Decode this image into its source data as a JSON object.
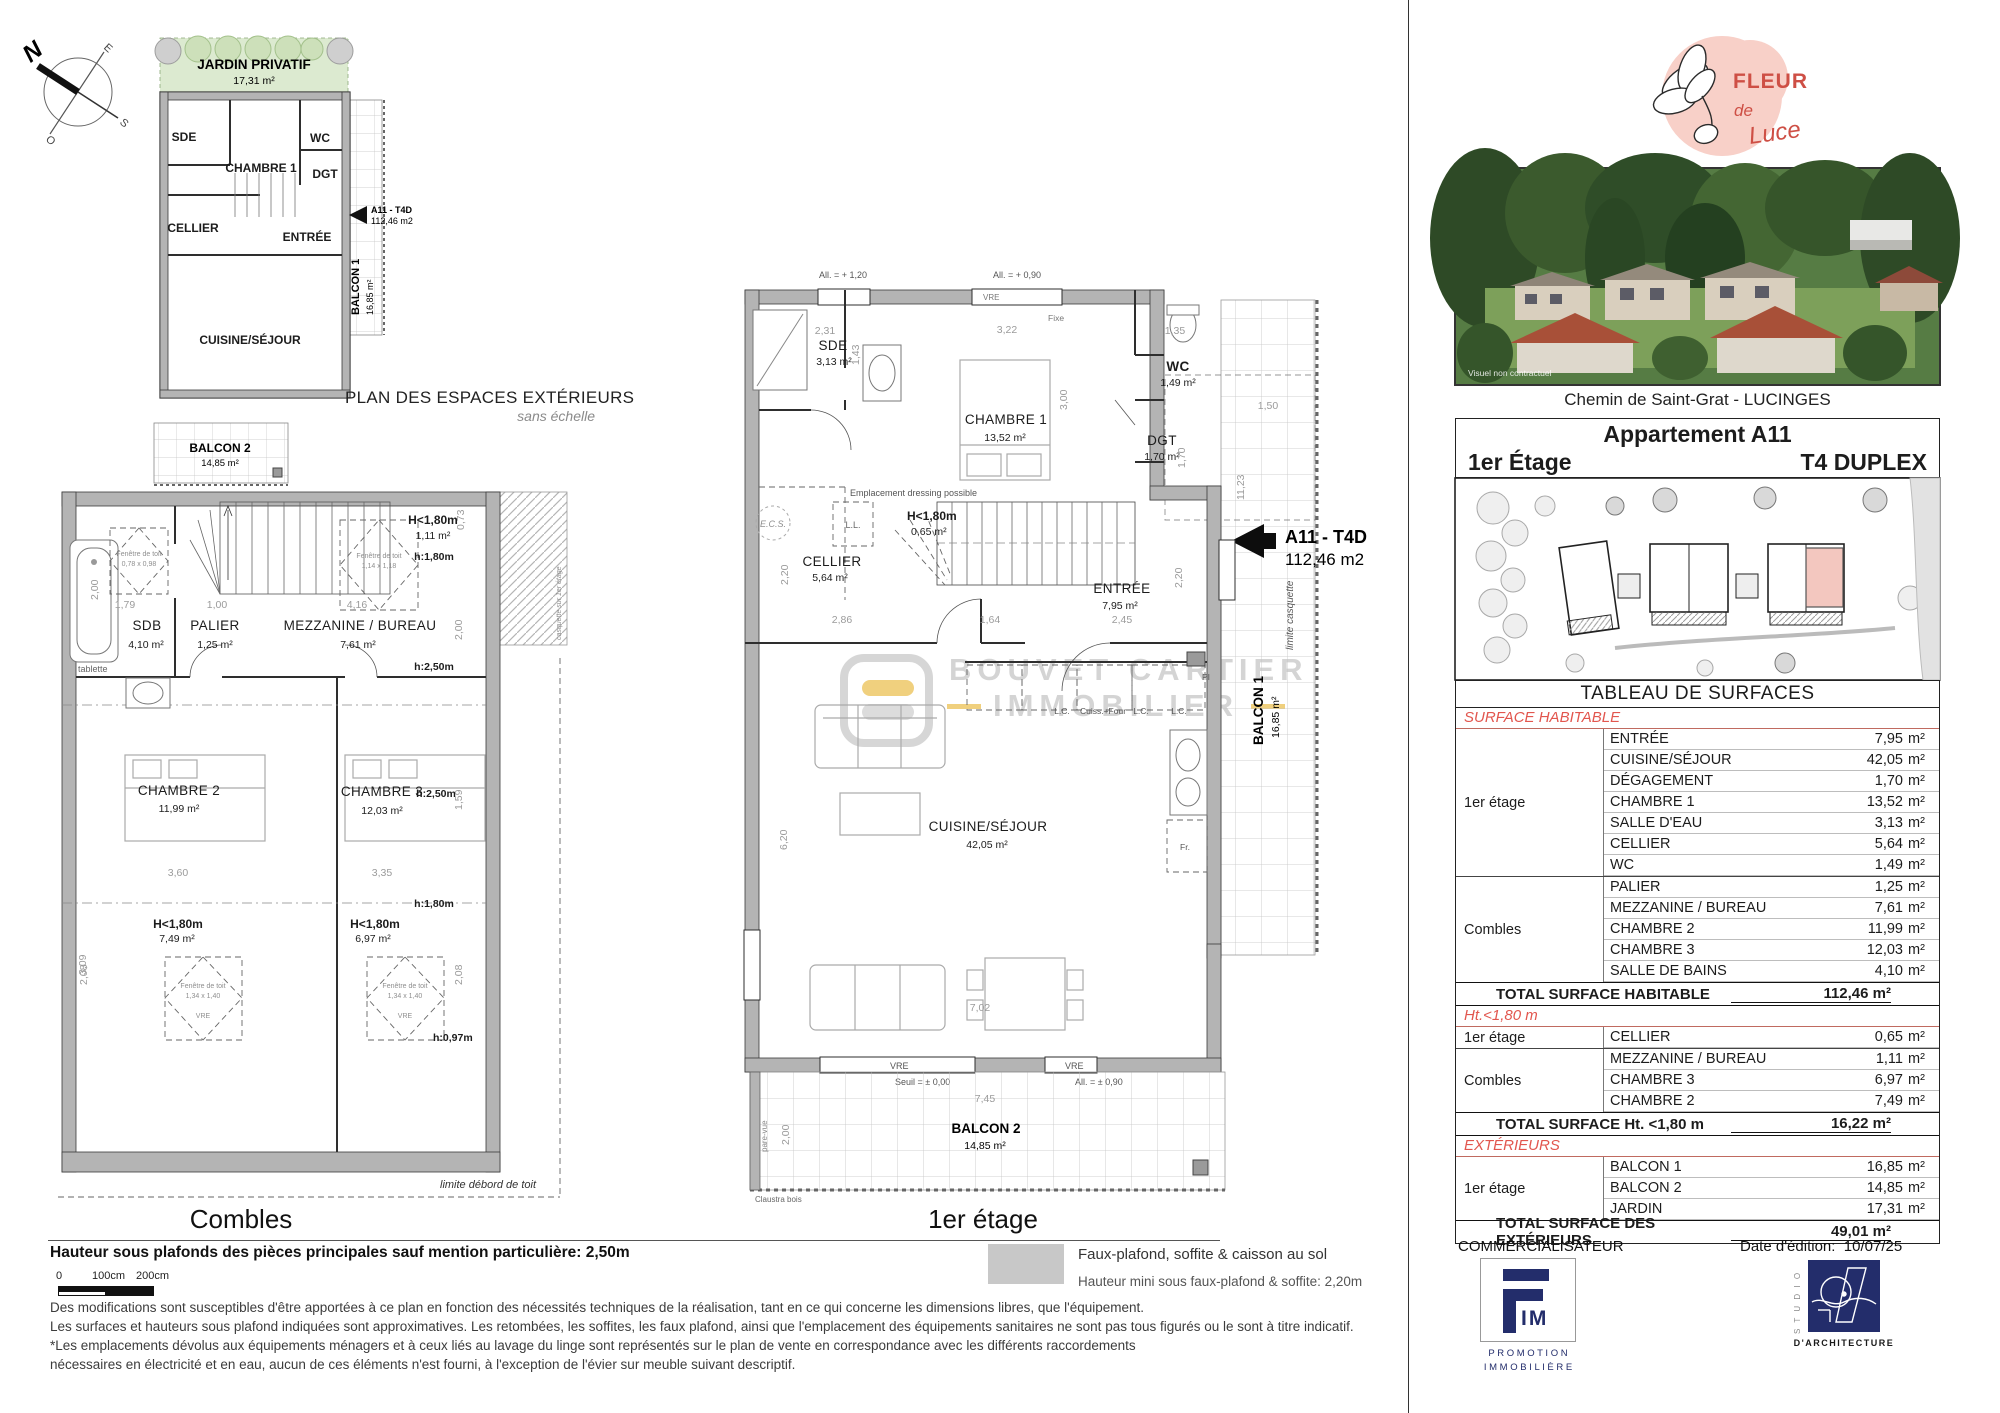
{
  "compass": {
    "n": "N",
    "e": "E",
    "s": "S",
    "o": "O"
  },
  "exterior_plan": {
    "title": "PLAN DES ESPACES EXTÉRIEURS",
    "subtitle": "sans échelle",
    "jardin_name": "JARDIN PRIVATIF",
    "jardin_area": "17,31 m²",
    "rooms": {
      "sde": "SDE",
      "chambre1": "CHAMBRE 1",
      "wc": "WC",
      "dgt": "DGT",
      "cellier": "CELLIER",
      "entree": "ENTRÉE",
      "cuisine": "CUISINE/SÉJOUR"
    },
    "balcon1_name": "BALCON 1",
    "balcon1_area": "16,85 m²",
    "balcon2_name": "BALCON 2",
    "balcon2_area": "14,85 m²",
    "tag_code": "A11 - T4D",
    "tag_area": "112,46 m2"
  },
  "combles": {
    "title": "Combles",
    "rooms": {
      "sdb": "SDB",
      "sdb_area": "4,10 m²",
      "palier": "PALIER",
      "palier_area": "1,25 m²",
      "mezz": "MEZZANINE / BUREAU",
      "mezz_area": "7,61 m²",
      "ch2": "CHAMBRE 2",
      "ch2_area": "11,99 m²",
      "ch3": "CHAMBRE 3",
      "ch3_area": "12,03 m²"
    },
    "low1": "H<1,80m",
    "low1_area": "1,11 m²",
    "low2_area": "7,49 m²",
    "low3_area": "6,97 m²",
    "notes": {
      "h180": "h:1,80m",
      "h250": "h:2,50m",
      "h097": "h:0,97m",
      "tablette": "tablette",
      "casquette": "casquette sur 1er étage",
      "limite": "limite débord de toit",
      "fen": "Fenêtre de toit",
      "fen_size": "1,34 x 1,40",
      "fen_size2": "1,14 x 1,18",
      "fen_size3": "0,78 x 0,98",
      "vre": "VRE"
    },
    "dims": {
      "d200": "2,00",
      "d179": "1,79",
      "d100": "1,00",
      "d416": "4,16",
      "d073": "0,73",
      "d360": "3,60",
      "d335": "3,35",
      "d309": "3,09",
      "d208": "2,08",
      "d159": "1,59"
    }
  },
  "etage": {
    "title": "1er étage",
    "rooms": {
      "sde": "SDE",
      "sde_area": "3,13 m²",
      "ch1": "CHAMBRE 1",
      "ch1_area": "13,52 m²",
      "wc": "WC",
      "wc_area": "1,49 m²",
      "dgt": "DGT",
      "dgt_area": "1,70 m²",
      "cellier": "CELLIER",
      "cellier_area": "5,64 m²",
      "entree": "ENTRÉE",
      "entree_area": "7,95 m²",
      "cuisine": "CUISINE/SÉJOUR",
      "cuisine_area": "42,05 m²",
      "balcon1": "BALCON 1",
      "balcon1_area": "16,85 m²",
      "balcon2": "BALCON 2",
      "balcon2_area": "14,85 m²"
    },
    "low": "H<1,80m",
    "low_area": "0,65 m²",
    "tag_code": "A11 - T4D",
    "tag_area": "112,46 m2",
    "labels": {
      "ecs": "E.C.S.",
      "ll": "L.L.",
      "lc": "L.C.",
      "cuiss": "Cuiss.+Four",
      "pi": "PI",
      "fr": "Fr.",
      "vre": "VRE",
      "fixe": "Fixe",
      "all120": "All. = + 1,20",
      "all090": "All. = + 0,90",
      "seuil": "Seuil = ± 0,00",
      "all090b": "All. = ± 0,90",
      "dressing": "Emplacement dressing possible",
      "limcasq": "limite casquette",
      "parevue": "pare-vue",
      "claustra": "Claustra bois"
    },
    "dims": {
      "d231": "2,31",
      "d143": "1,43",
      "d322": "3,22",
      "d135": "1,35",
      "d300": "3,00",
      "d170": "1,70",
      "d220": "2,20",
      "d286": "2,86",
      "d164": "1,64",
      "d245": "2,45",
      "d620": "6,20",
      "d702": "7,02",
      "d745": "7,45",
      "d200": "2,00",
      "d150": "1,50",
      "d1123": "11,23"
    }
  },
  "watermark": {
    "line1": "BOUVET CARTIER",
    "line2": "IMMOBILIER"
  },
  "legend": {
    "line1": "Faux-plafond, soffite & caisson au sol",
    "line2": "Hauteur mini sous faux-plafond & soffite: 2,20m"
  },
  "notes": {
    "height": "Hauteur sous plafonds des pièces principales sauf mention particulière: 2,50m",
    "scale0": "0",
    "scale100": "100cm",
    "scale200": "200cm",
    "d1": "Des modifications sont susceptibles d'être apportées à ce plan en fonction des nécessités techniques de la réalisation, tant en ce qui concerne les dimensions libres, que l'équipement.",
    "d2": "Les surfaces et hauteurs sous plafond indiquées sont approximatives. Les retombées, les soffites, les faux plafond, ainsi que l'emplacement des équipements sanitaires ne sont pas tous figurés ou le sont à titre indicatif.",
    "d3": "*Les emplacements dévolus aux équipements ménagers et à ceux liés au lavage du linge sont représentés sur le plan de vente en correspondance avec les différents raccordements",
    "d4": "nécessaires en électricité et en eau, aucun de ces éléments n'est fourni, à l'exception de l'évier sur meuble suivant descriptif."
  },
  "brand": {
    "fleur": "FLEUR",
    "de": "de",
    "luce": "Luce"
  },
  "photo": {
    "caption": "Visuel non contractuel"
  },
  "address": "Chemin de Saint-Grat - LUCINGES",
  "unit": {
    "name": "Appartement A11",
    "floor": "1er Étage",
    "type": "T4 DUPLEX"
  },
  "surface_table": {
    "title": "TABLEAU DE SURFACES",
    "floors": {
      "etage": "1er étage",
      "combles": "Combles"
    },
    "unit": "m²",
    "s1": {
      "label": "SURFACE HABITABLE",
      "rows": [
        [
          "ENTRÉE",
          "7,95"
        ],
        [
          "CUISINE/SÉJOUR",
          "42,05"
        ],
        [
          "DÉGAGEMENT",
          "1,70"
        ],
        [
          "CHAMBRE 1",
          "13,52"
        ],
        [
          "SALLE D'EAU",
          "3,13"
        ],
        [
          "CELLIER",
          "5,64"
        ],
        [
          "WC",
          "1,49"
        ],
        [
          "PALIER",
          "1,25"
        ],
        [
          "MEZZANINE / BUREAU",
          "7,61"
        ],
        [
          "CHAMBRE 2",
          "11,99"
        ],
        [
          "CHAMBRE 3",
          "12,03"
        ],
        [
          "SALLE DE BAINS",
          "4,10"
        ]
      ],
      "total_label": "TOTAL SURFACE HABITABLE",
      "total": "112,46 m²"
    },
    "s2": {
      "label": "Ht.<1,80 m",
      "rows": [
        [
          "CELLIER",
          "0,65"
        ],
        [
          "MEZZANINE / BUREAU",
          "1,11"
        ],
        [
          "CHAMBRE 3",
          "6,97"
        ],
        [
          "CHAMBRE 2",
          "7,49"
        ]
      ],
      "total_label": "TOTAL SURFACE Ht. <1,80 m",
      "total": "16,22 m²"
    },
    "s3": {
      "label": "EXTÉRIEURS",
      "rows": [
        [
          "BALCON 1",
          "16,85"
        ],
        [
          "BALCON 2",
          "14,85"
        ],
        [
          "JARDIN",
          "17,31"
        ]
      ],
      "total_label": "TOTAL SURFACE  DES EXTÉRIEURS",
      "total": "49,01 m²"
    }
  },
  "footer": {
    "commercialisateur": "COMMERCIALISATEUR",
    "date_label": "Date d'édition:",
    "date": "10/07/25",
    "fim_im": "IM",
    "fim_line1": "P R O M O T I O N",
    "fim_line2": "I M M O B I L I È R E",
    "studio_vertical": "S T U D I O",
    "studio_label": "D'ARCHITECTURE"
  }
}
